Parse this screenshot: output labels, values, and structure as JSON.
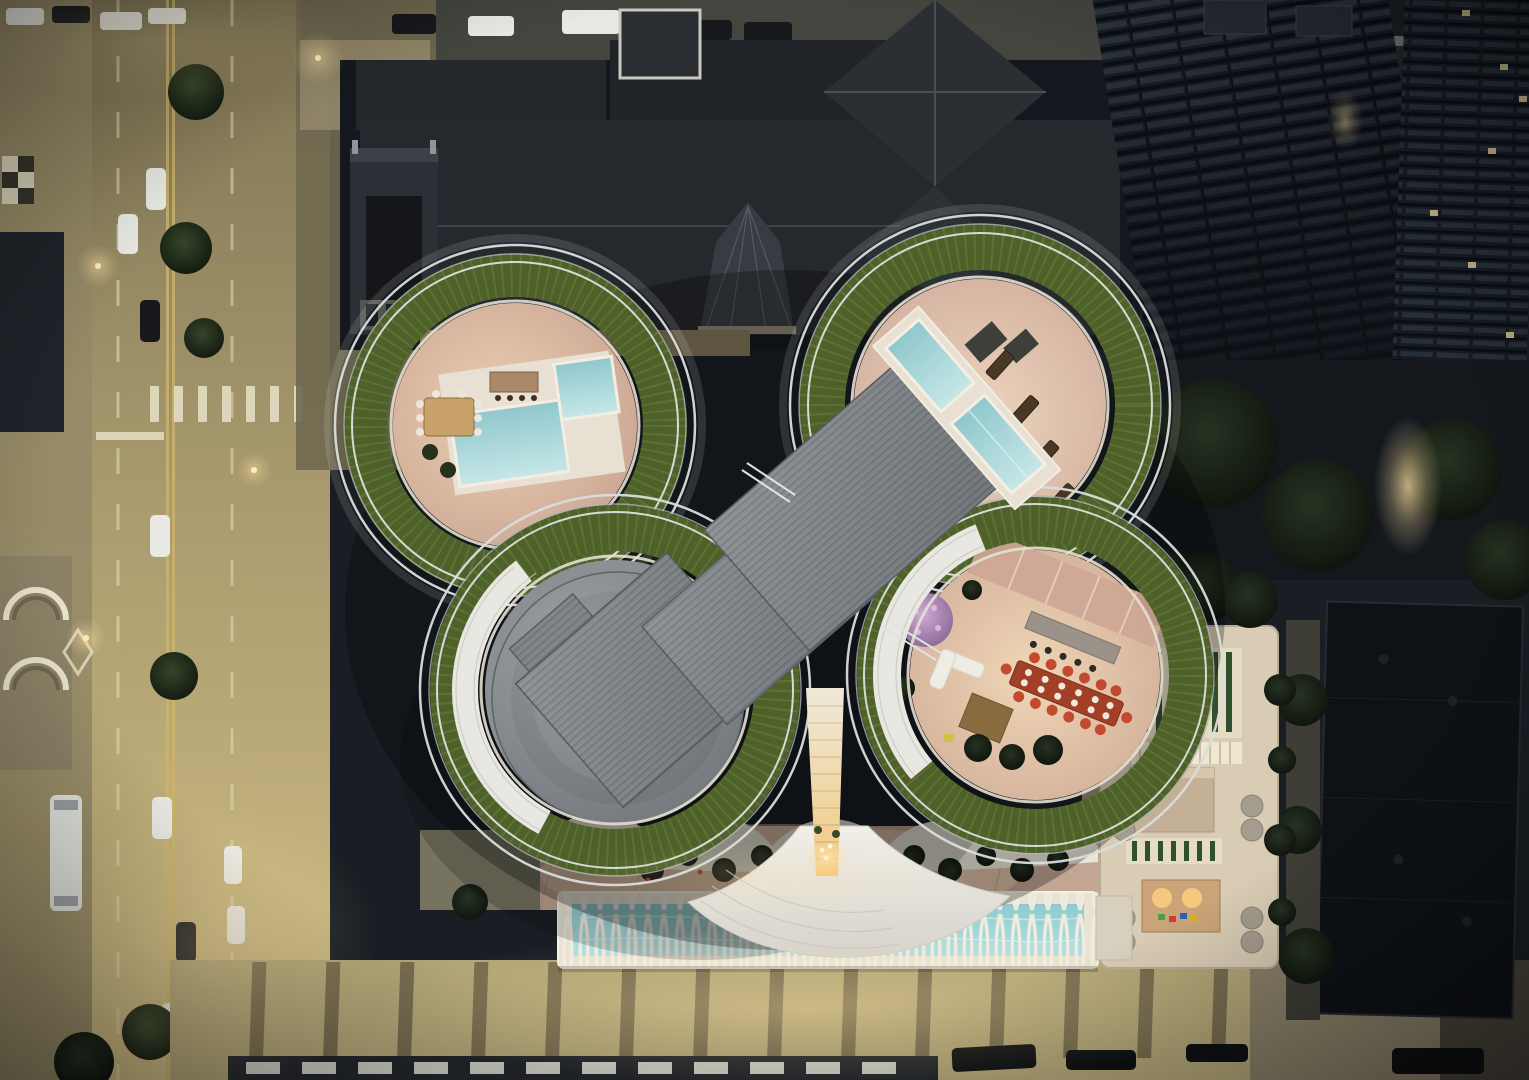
{
  "scene": {
    "type": "aerial-photograph",
    "view": "top-down drone view at dusk",
    "description": "Dusk aerial view straight down onto a butterfly-shaped high-rise rooftop with four rounded clover terraces ringed by green roof planting and white guardrails; two terraces hold pale blue pools and lounge furniture, one holds a long dining table with orange chairs, one is a grey circular mechanical roof. Angled grey roof slabs and a white ribbed tower core with a warm glowing canyon sit at the center. Below is a plaza with trees, a long lap pool under a white lattice canopy, a cream podium roof deck with green striped skylights, a dark church with conical spire above, lamp-lit streets with cars on the left and bottom, and dark residential towers at the upper right."
  },
  "features": {
    "tower_petals": 4,
    "upper_rooftop_pools": 4,
    "lap_pool": 1,
    "dining_tables": 2,
    "lounge_chairs": 4,
    "street_side": "left and bottom",
    "church_position": "top center",
    "towers_position": "top right",
    "lighting": "warm streetlights against cool dark city"
  },
  "palette": {
    "bg": "#1a1e24",
    "street_top": "#7e7454",
    "street_mid": "#a89a6e",
    "street_bot": "#d2bf85",
    "lane_line": "#eadfb6",
    "yellow_line": "#cdb469",
    "sidewalk_band": "#6d6349",
    "building_dark": "#14181e",
    "building_mid": "#262c35",
    "roof_church": "#25282d",
    "roof_facet": "#383c42",
    "green_ring": "#4e612b",
    "green_speck": "#72873a",
    "terrace_pink": "#c39c8b",
    "terrace_lit": "#ecd0b4",
    "pool_deck": "#e8e1d3",
    "pool_blue": "#a9d2d6",
    "roof_grey": "#8d9296",
    "roof_grey_dark": "#6f7478",
    "tower_white": "#e9e7e1",
    "rib_line": "#c6c4be",
    "glow_warm": "#ffe2a4",
    "lattice": "#f2ecdf",
    "lap_water": "#9ed2d6",
    "podium_cream": "#d9ccb4",
    "podium_stripe": "#31502e",
    "car_white": "#e9e9e4",
    "car_dark": "#16181c",
    "railing": "#d9dddd",
    "curb": "#e6dfd2",
    "table_red": "#a23f27",
    "chair_red": "#c24a2e",
    "purple_tree": "#b08ab8"
  }
}
